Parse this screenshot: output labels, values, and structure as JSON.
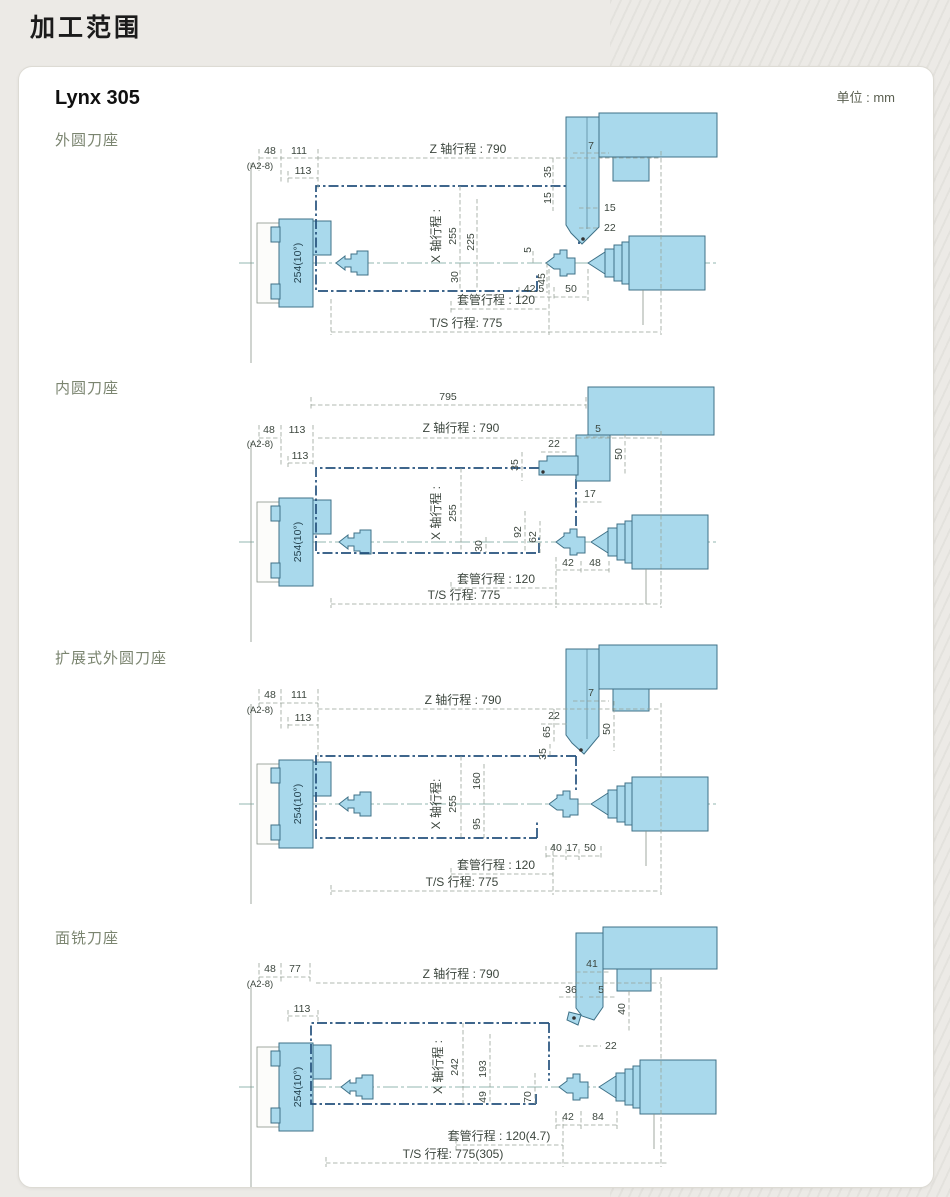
{
  "page": {
    "title": "加工范围"
  },
  "card": {
    "model": "Lynx 305",
    "unit": "单位 : mm",
    "colors": {
      "part_fill": "#a9d9ec",
      "part_stroke": "#3f7187",
      "envelope_line": "#24517c",
      "dimension_line": "#98a398",
      "background": "#eceae6"
    },
    "sections": [
      {
        "label": "外圆刀座",
        "dims": {
          "n48": "48",
          "a28": "(A2-8)",
          "n111": "111",
          "n113": "113",
          "z": "Z 轴行程 : 790",
          "t7": "7",
          "v35": "35",
          "v15": "15",
          "h15": "15",
          "h22": "22",
          "xt": "X 轴行程 :",
          "x1": "255",
          "x2": "225",
          "v30": "30",
          "v5": "5",
          "v45": "45",
          "h425": "42.5",
          "h50": "50",
          "chuck": "254(10°)",
          "sleeve": "套管行程 : 120",
          "ts": "T/S 行程: 775"
        }
      },
      {
        "label": "内圆刀座",
        "dims": {
          "n795": "795",
          "z": "Z 轴行程 : 790",
          "n48": "48",
          "a28": "(A2-8)",
          "n113a": "113",
          "n113b": "113",
          "h22": "22",
          "t5": "5",
          "v50": "50",
          "v35": "35",
          "h17": "17",
          "xt": "X 轴行程 :",
          "x1": "255",
          "v30": "30",
          "v92": "92",
          "v62": "62",
          "h42": "42",
          "h48": "48",
          "chuck": "254(10°)",
          "sleeve": "套管行程 : 120",
          "ts": "T/S 行程: 775"
        }
      },
      {
        "label": "扩展式外圆刀座",
        "dims": {
          "n48": "48",
          "a28": "(A2-8)",
          "n111": "111",
          "n113": "113",
          "z": "Z 轴行程 : 790",
          "t7": "7",
          "h22": "22",
          "v65": "65",
          "v35": "35",
          "v50": "50",
          "xt": "X 轴行程:",
          "x1": "255",
          "v160": "160",
          "v95": "95",
          "h40": "40",
          "h17": "17",
          "h50": "50",
          "chuck": "254(10°)",
          "sleeve": "套管行程 : 120",
          "ts": "T/S 行程: 775"
        }
      },
      {
        "label": "面铣刀座",
        "dims": {
          "n48": "48",
          "a28": "(A2-8)",
          "n77": "77",
          "n113": "113",
          "z": "Z 轴行程 : 790",
          "n41": "41",
          "n36": "36",
          "t5": "5",
          "v40": "40",
          "h22": "22",
          "xt": "X 轴行程 :",
          "x1": "242",
          "v193": "193",
          "v49": "49",
          "v70": "70",
          "h42": "42",
          "h84": "84",
          "chuck": "254(10°)",
          "sleeve": "套管行程 : 120(4.7)",
          "ts": "T/S 行程: 775(305)"
        }
      }
    ]
  }
}
